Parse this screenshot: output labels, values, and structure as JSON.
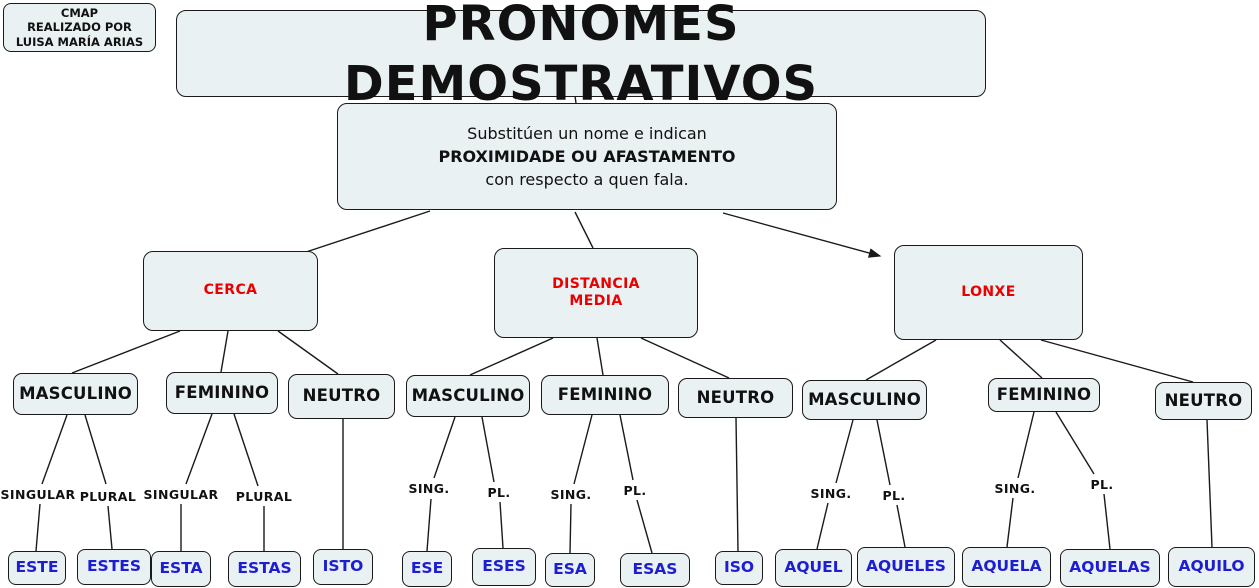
{
  "credit": {
    "text": "CMAP\nREALIZADO POR\nLUISA MARÍA ARIAS"
  },
  "title": "PRONOMES DEMOSTRATIVOS",
  "definition": {
    "line1": "Substitúen un nome e indican",
    "line2": "PROXIMIDADE OU AFASTAMENTO",
    "line3": "con respecto a quen fala."
  },
  "categories": [
    {
      "label": "CERCA"
    },
    {
      "label": "DISTANCIA\nMEDIA"
    },
    {
      "label": "LONXE"
    }
  ],
  "genders": [
    {
      "label": "MASCULINO"
    },
    {
      "label": "FEMININO"
    },
    {
      "label": "NEUTRO"
    },
    {
      "label": "MASCULINO"
    },
    {
      "label": "FEMININO"
    },
    {
      "label": "NEUTRO"
    },
    {
      "label": "MASCULINO"
    },
    {
      "label": "FEMININO"
    },
    {
      "label": "NEUTRO"
    }
  ],
  "number_labels": [
    {
      "label": "SINGULAR"
    },
    {
      "label": "PLURAL"
    },
    {
      "label": "SINGULAR"
    },
    {
      "label": "PLURAL"
    },
    {
      "label": "SING."
    },
    {
      "label": "PL."
    },
    {
      "label": "SING."
    },
    {
      "label": "PL."
    },
    {
      "label": "SING."
    },
    {
      "label": "PL."
    },
    {
      "label": "SING."
    },
    {
      "label": "PL."
    }
  ],
  "pronouns": [
    {
      "label": "ESTE"
    },
    {
      "label": "ESTES"
    },
    {
      "label": "ESTA"
    },
    {
      "label": "ESTAS"
    },
    {
      "label": "ISTO"
    },
    {
      "label": "ESE"
    },
    {
      "label": "ESES"
    },
    {
      "label": "ESA"
    },
    {
      "label": "ESAS"
    },
    {
      "label": "ISO"
    },
    {
      "label": "AQUEL"
    },
    {
      "label": "AQUELES"
    },
    {
      "label": "AQUELA"
    },
    {
      "label": "AQUELAS"
    },
    {
      "label": "AQUILO"
    }
  ],
  "colors": {
    "node-fill": "#e9f1f3",
    "node-border": "#1a1a1a",
    "category-red": "#e90000",
    "pronoun-blue": "#1d1dd1",
    "line": "#1a1a1a",
    "text": "#111111",
    "background": "#ffffff"
  },
  "edges": [
    {
      "x1": 575,
      "y1": 96,
      "x2": 576,
      "y2": 103,
      "arrow": false
    },
    {
      "x1": 430,
      "y1": 211,
      "x2": 303,
      "y2": 253,
      "arrow": false
    },
    {
      "x1": 575,
      "y1": 212,
      "x2": 593,
      "y2": 248,
      "arrow": false
    },
    {
      "x1": 723,
      "y1": 213,
      "x2": 880,
      "y2": 256,
      "arrow": true
    },
    {
      "x1": 180,
      "y1": 331,
      "x2": 72,
      "y2": 373,
      "arrow": false
    },
    {
      "x1": 228,
      "y1": 331,
      "x2": 221,
      "y2": 372,
      "arrow": false
    },
    {
      "x1": 278,
      "y1": 331,
      "x2": 338,
      "y2": 374,
      "arrow": false
    },
    {
      "x1": 553,
      "y1": 338,
      "x2": 470,
      "y2": 375,
      "arrow": false
    },
    {
      "x1": 597,
      "y1": 338,
      "x2": 603,
      "y2": 375,
      "arrow": false
    },
    {
      "x1": 641,
      "y1": 338,
      "x2": 729,
      "y2": 378,
      "arrow": false
    },
    {
      "x1": 936,
      "y1": 340,
      "x2": 866,
      "y2": 380,
      "arrow": false
    },
    {
      "x1": 1000,
      "y1": 340,
      "x2": 1042,
      "y2": 378,
      "arrow": false
    },
    {
      "x1": 1041,
      "y1": 340,
      "x2": 1193,
      "y2": 382,
      "arrow": false
    },
    {
      "x1": 67,
      "y1": 415,
      "x2": 42,
      "y2": 484,
      "arrow": false
    },
    {
      "x1": 85,
      "y1": 415,
      "x2": 106,
      "y2": 484,
      "arrow": false
    },
    {
      "x1": 40,
      "y1": 504,
      "x2": 36,
      "y2": 551,
      "arrow": false
    },
    {
      "x1": 108,
      "y1": 506,
      "x2": 112,
      "y2": 549,
      "arrow": false
    },
    {
      "x1": 212,
      "y1": 414,
      "x2": 186,
      "y2": 484,
      "arrow": false
    },
    {
      "x1": 234,
      "y1": 414,
      "x2": 258,
      "y2": 486,
      "arrow": false
    },
    {
      "x1": 181,
      "y1": 504,
      "x2": 181,
      "y2": 551,
      "arrow": false
    },
    {
      "x1": 264,
      "y1": 506,
      "x2": 264,
      "y2": 551,
      "arrow": false
    },
    {
      "x1": 343,
      "y1": 419,
      "x2": 343,
      "y2": 549,
      "arrow": false
    },
    {
      "x1": 455,
      "y1": 417,
      "x2": 434,
      "y2": 478,
      "arrow": false
    },
    {
      "x1": 482,
      "y1": 417,
      "x2": 494,
      "y2": 482,
      "arrow": false
    },
    {
      "x1": 431,
      "y1": 499,
      "x2": 427,
      "y2": 551,
      "arrow": false
    },
    {
      "x1": 500,
      "y1": 502,
      "x2": 503,
      "y2": 548,
      "arrow": false
    },
    {
      "x1": 592,
      "y1": 415,
      "x2": 574,
      "y2": 484,
      "arrow": false
    },
    {
      "x1": 620,
      "y1": 415,
      "x2": 633,
      "y2": 480,
      "arrow": false
    },
    {
      "x1": 571,
      "y1": 504,
      "x2": 570,
      "y2": 553,
      "arrow": false
    },
    {
      "x1": 637,
      "y1": 500,
      "x2": 652,
      "y2": 553,
      "arrow": false
    },
    {
      "x1": 736,
      "y1": 418,
      "x2": 738,
      "y2": 551,
      "arrow": false
    },
    {
      "x1": 853,
      "y1": 420,
      "x2": 836,
      "y2": 483,
      "arrow": false
    },
    {
      "x1": 877,
      "y1": 420,
      "x2": 890,
      "y2": 485,
      "arrow": false
    },
    {
      "x1": 828,
      "y1": 503,
      "x2": 817,
      "y2": 549,
      "arrow": false
    },
    {
      "x1": 897,
      "y1": 505,
      "x2": 905,
      "y2": 547,
      "arrow": false
    },
    {
      "x1": 1034,
      "y1": 412,
      "x2": 1018,
      "y2": 478,
      "arrow": false
    },
    {
      "x1": 1056,
      "y1": 412,
      "x2": 1094,
      "y2": 474,
      "arrow": false
    },
    {
      "x1": 1013,
      "y1": 498,
      "x2": 1007,
      "y2": 547,
      "arrow": false
    },
    {
      "x1": 1104,
      "y1": 494,
      "x2": 1110,
      "y2": 549,
      "arrow": false
    },
    {
      "x1": 1207,
      "y1": 420,
      "x2": 1212,
      "y2": 547,
      "arrow": false
    }
  ]
}
